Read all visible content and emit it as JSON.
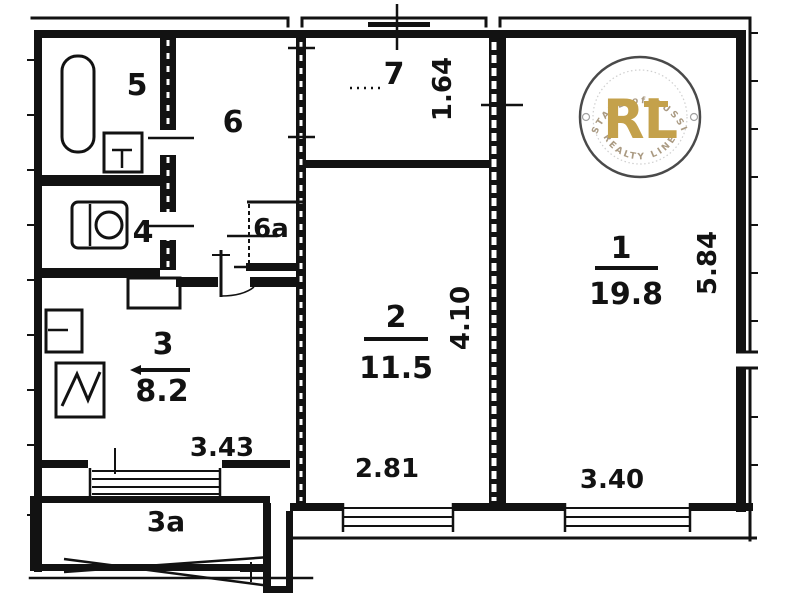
{
  "title": "Apartment floor plan",
  "rooms": {
    "r1": {
      "number": "1",
      "area": "19.8"
    },
    "r2": {
      "number": "2",
      "area": "11.5"
    },
    "r3": {
      "number": "3",
      "area": "8.2"
    },
    "r3a": {
      "number": "3a"
    },
    "r4": {
      "number": "4"
    },
    "r5": {
      "number": "5"
    },
    "r6": {
      "number": "6"
    },
    "r6a": {
      "number": "6a"
    },
    "r7": {
      "number": "7"
    }
  },
  "dims": {
    "room7_width": "1.64",
    "room2_height": "4.10",
    "room1_height": "5.84",
    "room3_width": "3.43",
    "room2_width": "2.81",
    "room1_width": "3.40"
  },
  "icons": {
    "bathtub": "bathtub-icon",
    "bath_sink": "sink-icon",
    "toilet": "toilet-icon",
    "kitchen_sink": "kitchen-sink-icon",
    "stove": "stove-icon"
  },
  "watermark": {
    "initials": "RL",
    "top_text": "ESTATE of RUSSIA",
    "bottom_text": "REALTY LINE",
    "gold": "#c09a3c",
    "ring": "#3b3b3b"
  }
}
